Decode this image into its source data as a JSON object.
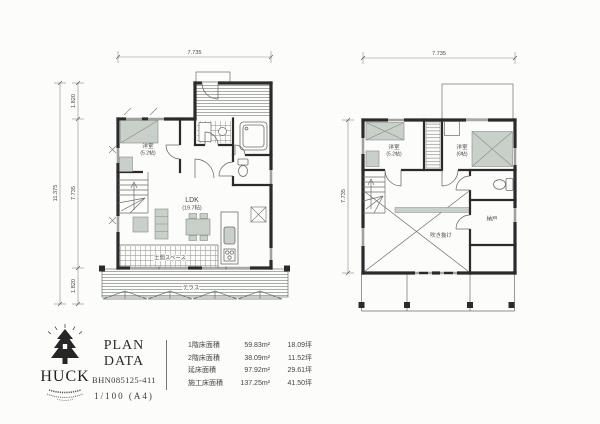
{
  "palette": {
    "ink": "#2b2b2b",
    "thin_line": "#666666",
    "furniture_gray": "#c9cfc9"
  },
  "floor1": {
    "dims": {
      "top": "7.735",
      "left_total": "11.375",
      "segments": [
        "1.820",
        "7.735",
        "1.820"
      ]
    },
    "labels": {
      "bedroom": "洋室",
      "bedroom_size": "(5.2帖)",
      "ldk": "LDK",
      "ldk_size": "(19.7帖)",
      "doma": "土間スペース",
      "terrace": "テラス"
    }
  },
  "floor2": {
    "dims": {
      "top": "7.735",
      "left": "7.735"
    },
    "labels": {
      "bedroom1": "洋室",
      "bedroom1_size": "(5.2帖)",
      "bedroom2": "洋室",
      "bedroom2_size": "(6帖)",
      "void": "吹き抜け",
      "storage": "納戸"
    }
  },
  "titleblock": {
    "logo": "HUCK",
    "title": "PLAN DATA",
    "code": "BHN085125-411",
    "scale": "1/100 (A4)",
    "areas": {
      "rows": [
        {
          "label": "1階床面積",
          "sqm": "59.83m²",
          "tsubo": "18.09坪"
        },
        {
          "label": "2階床面積",
          "sqm": "38.09m²",
          "tsubo": "11.52坪"
        },
        {
          "label": "延床面積",
          "sqm": "97.92m²",
          "tsubo": "29.61坪"
        },
        {
          "label": "施工床面積",
          "sqm": "137.25m²",
          "tsubo": "41.50坪"
        }
      ]
    }
  }
}
